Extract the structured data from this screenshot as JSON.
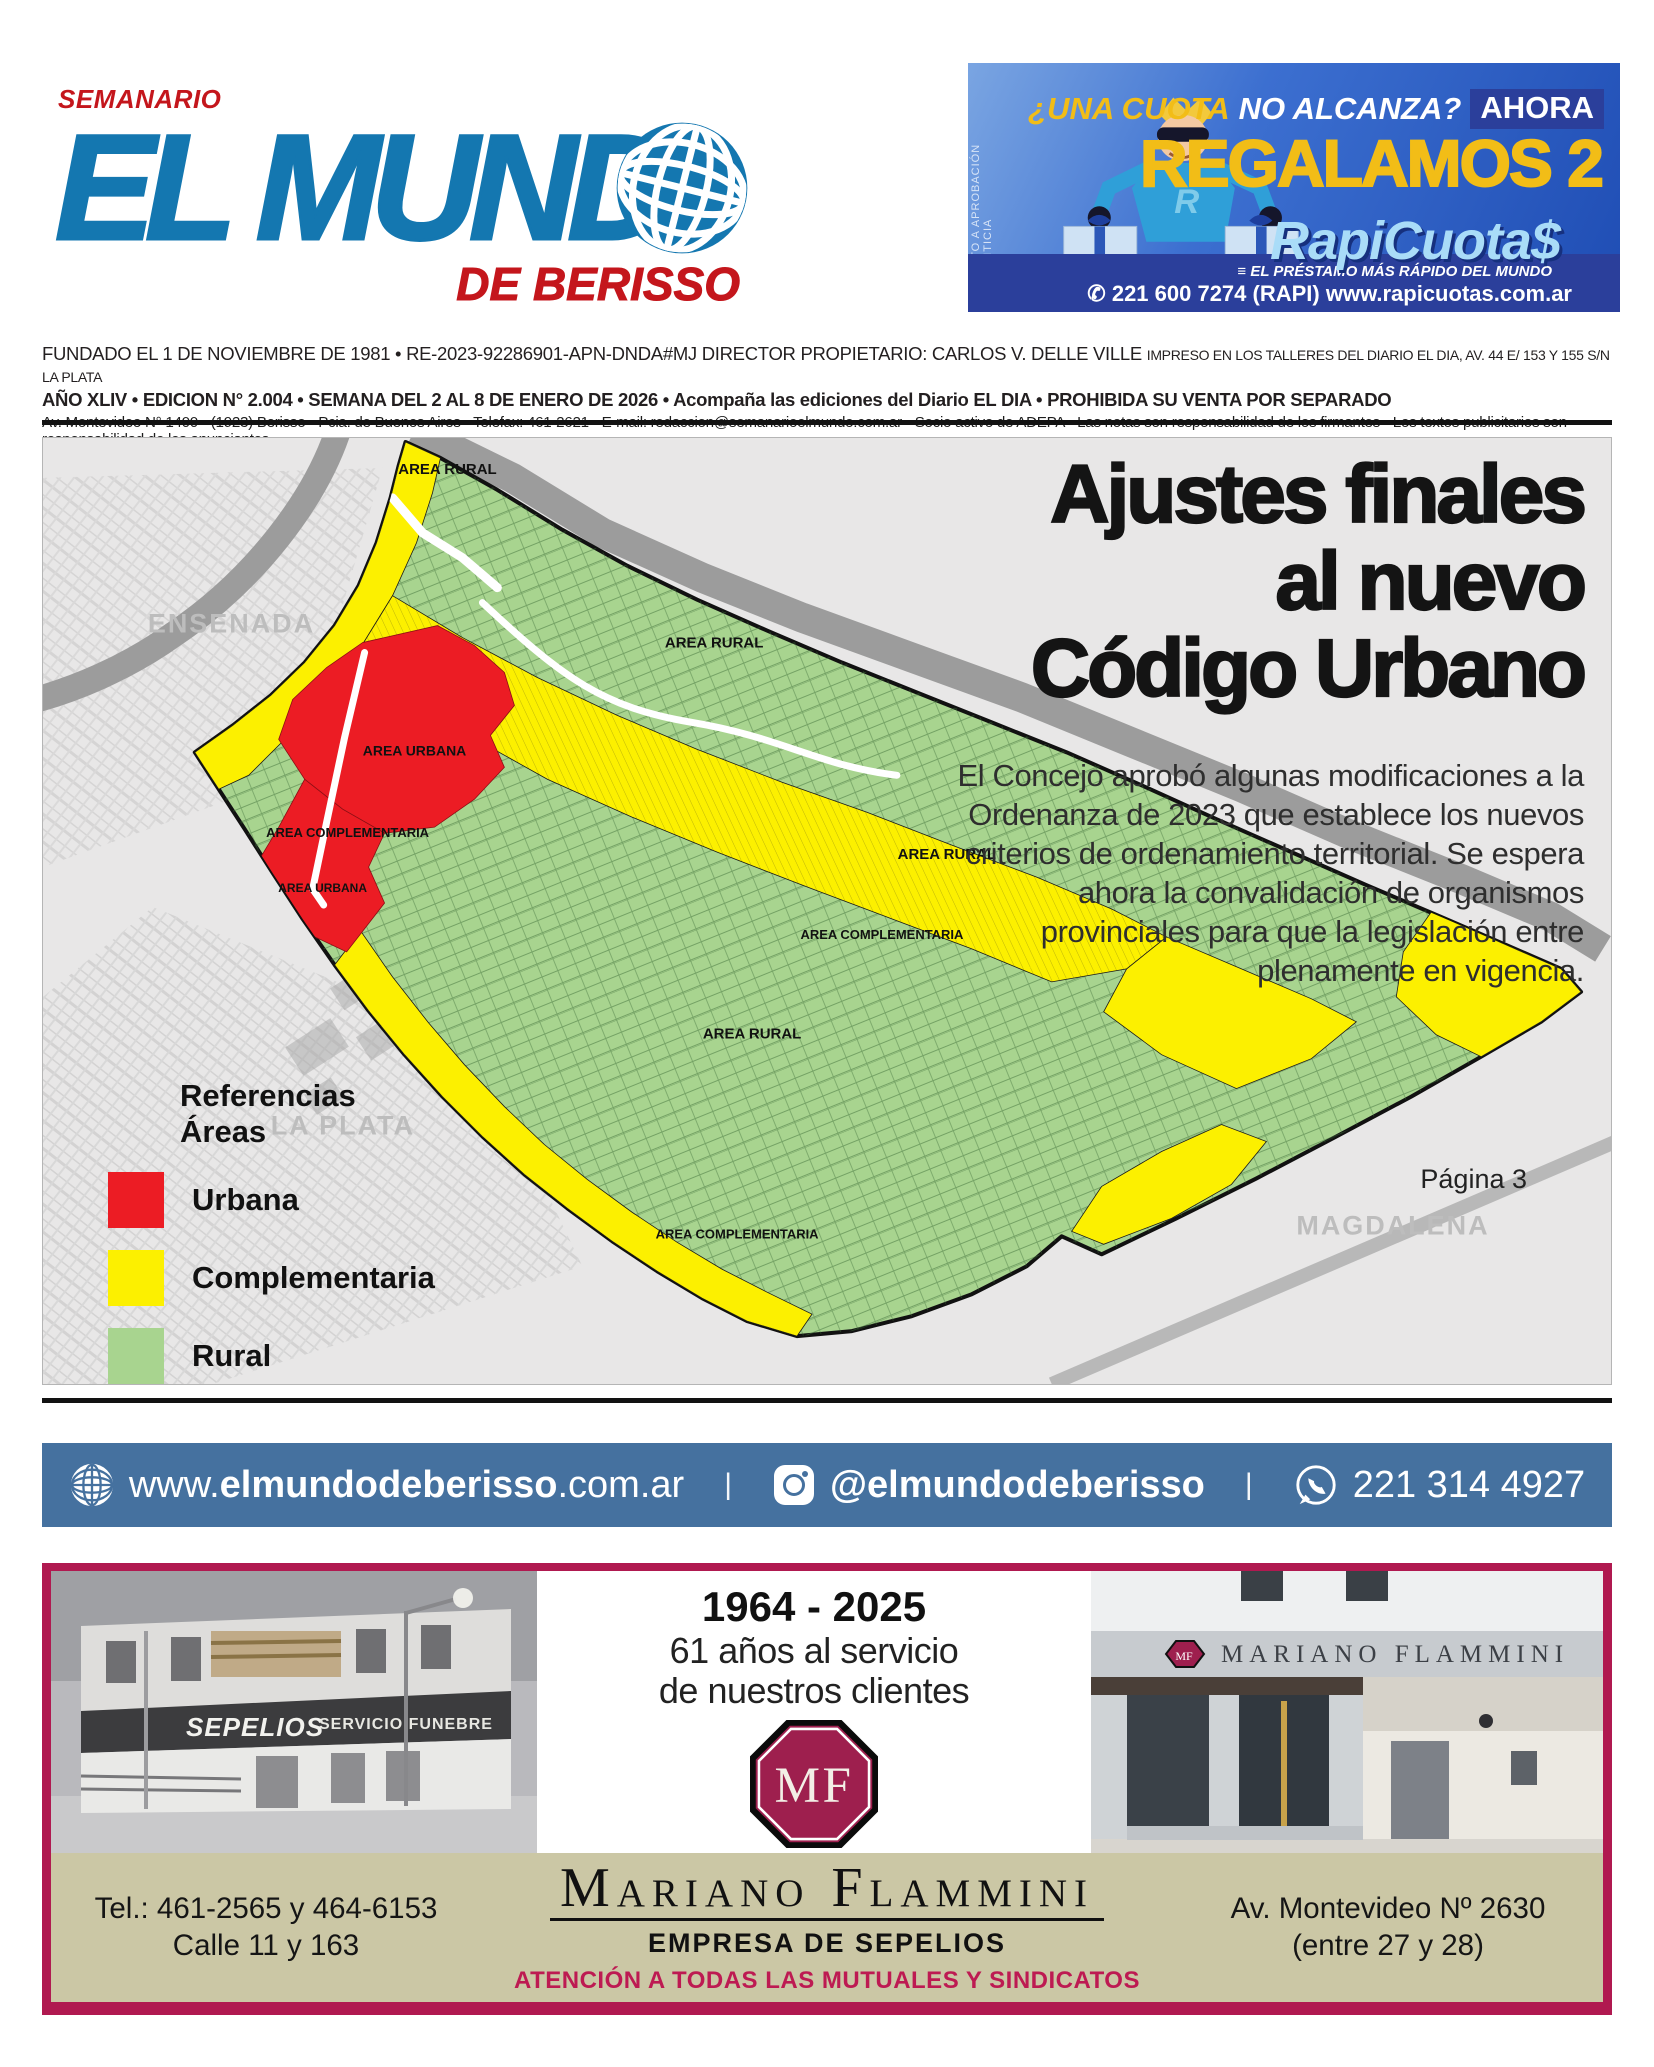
{
  "masthead": {
    "kicker": "SEMANARIO",
    "title": "EL MUND",
    "subtitle": "DE BERISSO"
  },
  "top_ad": {
    "vertical_note": "SUJETO A APROBACIÓN CREDITICIA",
    "headline_yellow": "¿UNA CUOTA",
    "headline_white": "NO ALCANZA?",
    "badge": "AHORA",
    "big_line": "REGALAMOS 2",
    "brand": "RapiCuota$",
    "tagline": "EL PRÉSTAMO MÁS RÁPIDO DEL MUNDO",
    "contact": "221 600 7274 (RAPI) www.rapicuotas.com.ar"
  },
  "folio": {
    "line1_main": "FUNDADO EL 1 DE NOVIEMBRE DE 1981 • RE-2023-92286901-APN-DNDA#MJ DIRECTOR PROPIETARIO: CARLOS V. DELLE VILLE",
    "line1_small": "IMPRESO EN LOS TALLERES DEL DIARIO EL DIA, AV. 44 E/ 153 Y 155 S/N LA PLATA",
    "line2": "AÑO XLIV •  EDICION N° 2.004 • SEMANA DEL 2 AL 8 DE ENERO DE 2026 • Acompaña las ediciones del Diario EL DIA • PROHIBIDA SU VENTA POR SEPARADO",
    "line3": "Av. Montevideo N° 1400 • (1923) Berisso • Pcia. de Buenos Aires • Telefax: 461-2621 • E-mail: redaccion@semanarioelmundo.com.ar • Socio activo de ADEPA • Las notas son responsabilidad de los firmantes • Los textos publicitarios son responsabilidad de los anunciantes."
  },
  "article": {
    "headline": {
      "line1": "Ajustes finales",
      "line2": "al nuevo",
      "line3": "Código Urbano"
    },
    "body": "El Concejo aprobó algunas modificaciones a la Ordenanza de 2023 que establece los nuevos criterios de ordenamiento territorial. Se espera ahora la convalidación de organismos provinciales para que la legislación entre plenamente en vigencia.",
    "page_ref": "Página 3",
    "legend": {
      "title_line1": "Referencias",
      "title_line2": "Áreas",
      "items": [
        {
          "label": "Urbana",
          "color": "#ec1c24"
        },
        {
          "label": "Complementaria",
          "color": "#fcf000"
        },
        {
          "label": "Rural",
          "color": "#a8d48f"
        }
      ]
    },
    "map": {
      "label_rural": "AREA RURAL",
      "label_complementaria": "AREA COMPLEMENTARIA",
      "label_urbana": "AREA URBANA",
      "city_ensenada": "ENSENADA",
      "city_la_plata": "LA PLATA",
      "city_magdalena": "MAGDALENA"
    }
  },
  "contact_bar": {
    "web_prefix": "www.",
    "web_bold": "elmundodeberisso",
    "web_suffix": ".com.ar",
    "divider": "|",
    "instagram": "@elmundodeberisso",
    "phone": "221 314 4927"
  },
  "bottom_ad": {
    "years": "1964 - 2025",
    "service_line1": "61 años al servicio",
    "service_line2": "de nuestros clientes",
    "logo_initials": "MF",
    "name": "Mariano Flammini",
    "subtitle": "EMPRESA DE SEPELIOS",
    "note": "ATENCIÓN A TODAS LAS MUTUALES Y SINDICATOS",
    "phones_line1": "Tel.: 461-2565 y 464-6153",
    "phones_line2": "Calle 11 y 163",
    "address_line1": "Av. Montevideo Nº 2630",
    "address_line2": "(entre 27 y 28)",
    "photo_left_sign1": "SEPELIOS",
    "photo_left_sign2": "SERVICIO FUNEBRE",
    "photo_right_sign": "MARIANO FLAMMINI"
  }
}
